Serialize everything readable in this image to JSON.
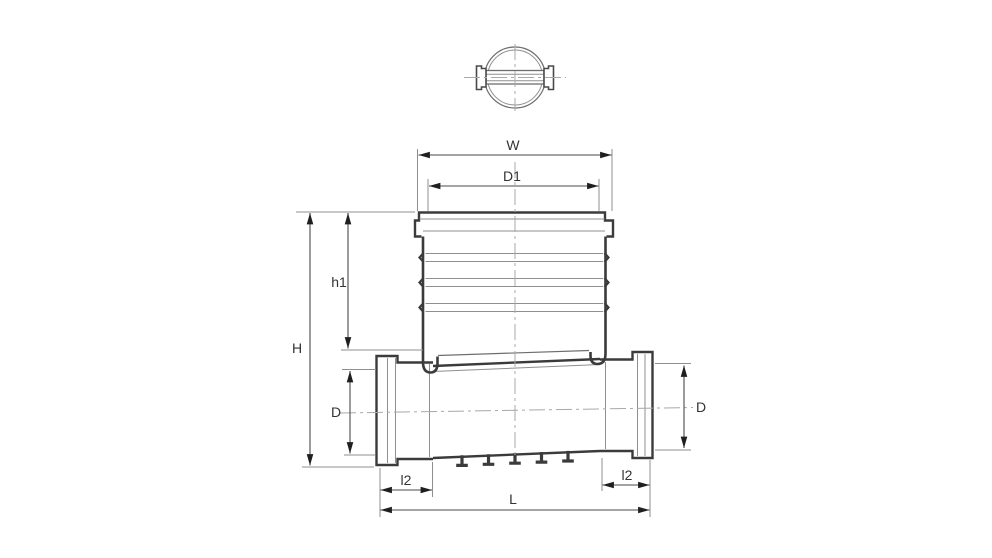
{
  "drawing": {
    "kind": "pipe-inspection-chamber-technical-drawing",
    "dimensions": {
      "W": "W",
      "D1": "D1",
      "h1": "h1",
      "H": "H",
      "D_left": "D",
      "D_right": "D",
      "l2_left": "l2",
      "l2_right": "l2",
      "L": "L"
    },
    "colors": {
      "background": "#ffffff",
      "outline": "#3b3b3b",
      "thin_line": "#8f8f8f",
      "centerline": "#a8a8a8",
      "dimension_line": "#4a4a4a",
      "label_text": "#333333"
    }
  }
}
